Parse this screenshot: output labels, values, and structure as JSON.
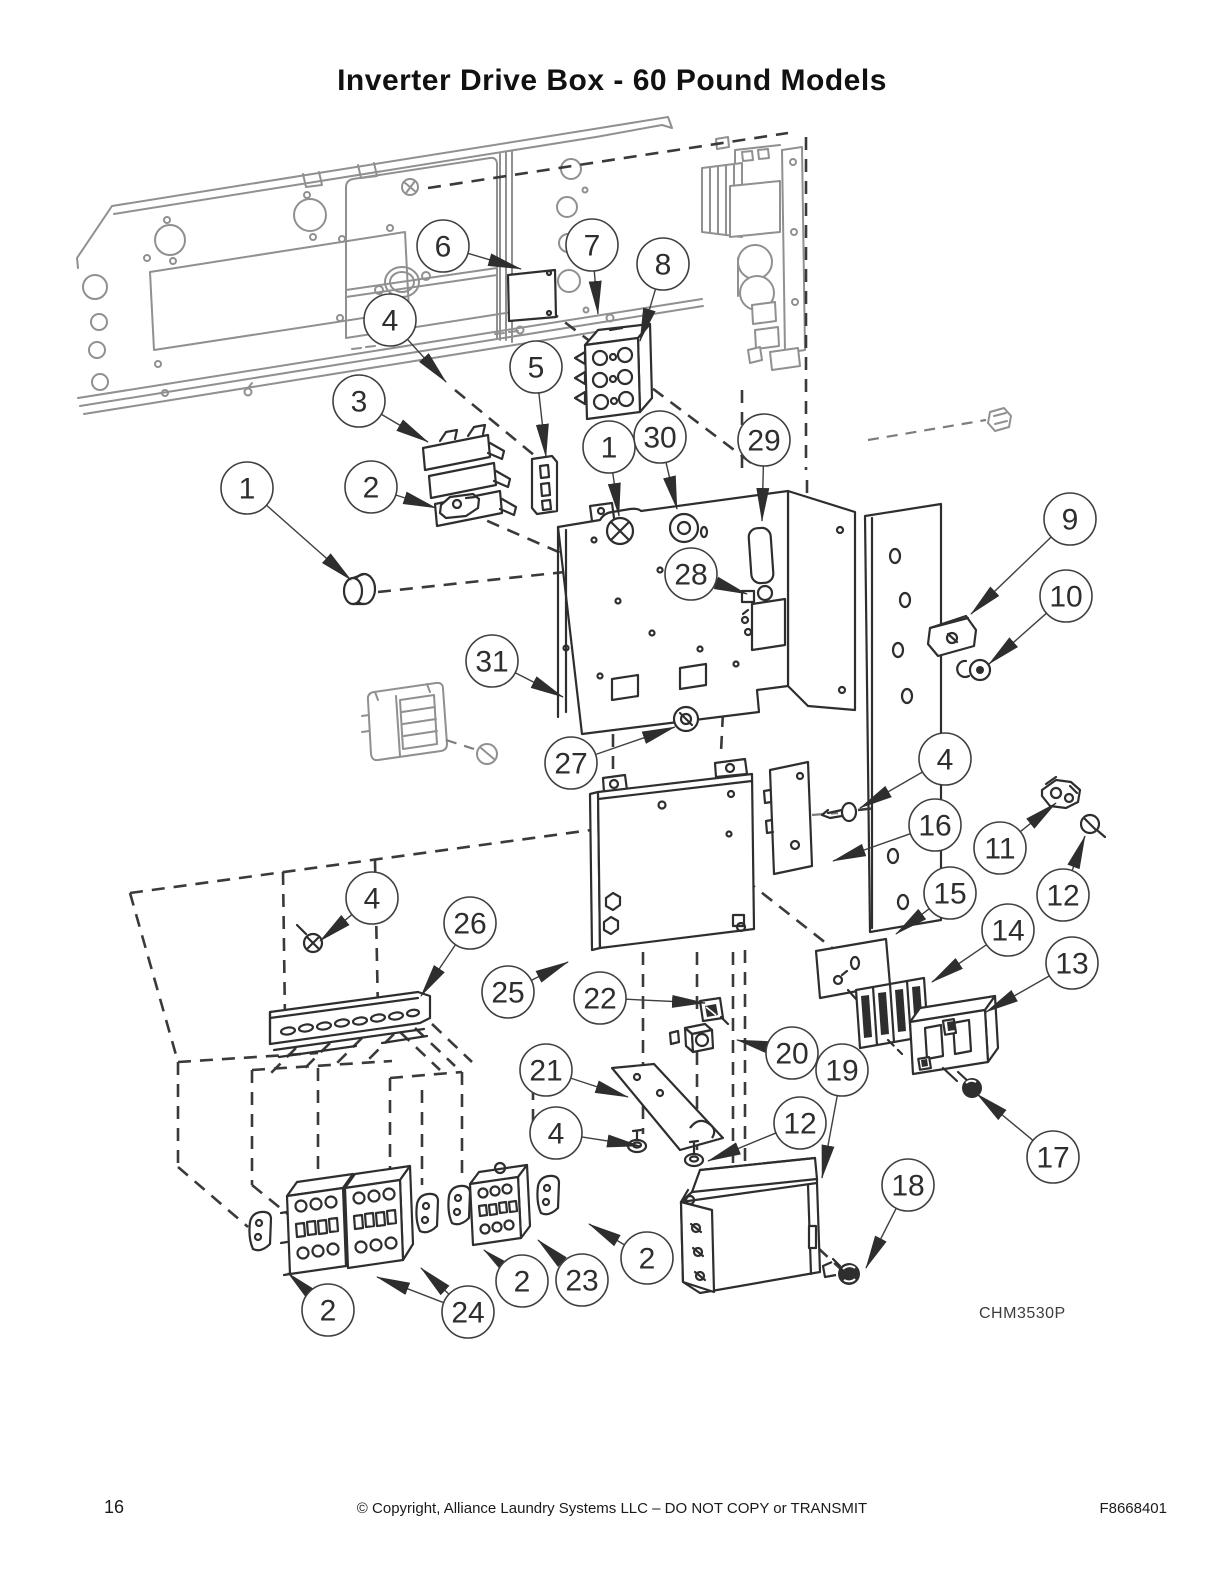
{
  "title": "Inverter Drive Box - 60 Pound Models",
  "figure_code": "CHM3530P",
  "footer": {
    "page_number": "16",
    "copyright": "© Copyright, Alliance Laundry Systems LLC – DO NOT COPY or TRANSMIT",
    "document_number": "F8668401"
  },
  "colors": {
    "ink": "#2e2e2e",
    "ghost": "#909090",
    "balloon_stroke": "#3f3f3f"
  },
  "balloon": {
    "radius": 26,
    "font_size": 30
  },
  "callouts": [
    {
      "label": "6",
      "cx": 443,
      "cy": 246,
      "targets": [
        [
          521,
          269
        ]
      ]
    },
    {
      "label": "7",
      "cx": 592,
      "cy": 245,
      "targets": [
        [
          598,
          314
        ]
      ]
    },
    {
      "label": "8",
      "cx": 663,
      "cy": 264,
      "targets": [
        [
          640,
          341
        ]
      ]
    },
    {
      "label": "4",
      "cx": 390,
      "cy": 320,
      "targets": [
        [
          446,
          382
        ]
      ]
    },
    {
      "label": "5",
      "cx": 536,
      "cy": 367,
      "targets": [
        [
          546,
          457
        ]
      ]
    },
    {
      "label": "3",
      "cx": 359,
      "cy": 401,
      "targets": [
        [
          428,
          442
        ]
      ]
    },
    {
      "label": "1",
      "cx": 609,
      "cy": 447,
      "targets": [
        [
          619,
          516
        ]
      ]
    },
    {
      "label": "30",
      "cx": 660,
      "cy": 437,
      "targets": [
        [
          677,
          509
        ]
      ]
    },
    {
      "label": "29",
      "cx": 764,
      "cy": 440,
      "targets": [
        [
          762,
          521
        ]
      ]
    },
    {
      "label": "1",
      "cx": 247,
      "cy": 488,
      "targets": [
        [
          351,
          580
        ]
      ]
    },
    {
      "label": "2",
      "cx": 371,
      "cy": 487,
      "targets": [
        [
          436,
          508
        ]
      ]
    },
    {
      "label": "9",
      "cx": 1070,
      "cy": 519,
      "targets": [
        [
          971,
          614
        ]
      ]
    },
    {
      "label": "28",
      "cx": 691,
      "cy": 574,
      "targets": [
        [
          747,
          594
        ]
      ]
    },
    {
      "label": "10",
      "cx": 1066,
      "cy": 596,
      "targets": [
        [
          989,
          664
        ]
      ]
    },
    {
      "label": "31",
      "cx": 492,
      "cy": 661,
      "targets": [
        [
          563,
          697
        ]
      ]
    },
    {
      "label": "27",
      "cx": 571,
      "cy": 763,
      "targets": [
        [
          675,
          727
        ]
      ]
    },
    {
      "label": "4",
      "cx": 945,
      "cy": 759,
      "targets": [
        [
          860,
          808
        ]
      ]
    },
    {
      "label": "16",
      "cx": 935,
      "cy": 825,
      "targets": [
        [
          833,
          861
        ]
      ]
    },
    {
      "label": "11",
      "cx": 1000,
      "cy": 848,
      "targets": [
        [
          1056,
          803
        ]
      ]
    },
    {
      "label": "15",
      "cx": 950,
      "cy": 893,
      "targets": [
        [
          896,
          934
        ]
      ]
    },
    {
      "label": "12",
      "cx": 1063,
      "cy": 895,
      "targets": [
        [
          1085,
          836
        ]
      ]
    },
    {
      "label": "14",
      "cx": 1008,
      "cy": 930,
      "targets": [
        [
          932,
          982
        ]
      ]
    },
    {
      "label": "13",
      "cx": 1072,
      "cy": 963,
      "targets": [
        [
          986,
          1012
        ]
      ]
    },
    {
      "label": "4",
      "cx": 372,
      "cy": 898,
      "targets": [
        [
          320,
          941
        ]
      ]
    },
    {
      "label": "26",
      "cx": 470,
      "cy": 923,
      "targets": [
        [
          421,
          996
        ]
      ]
    },
    {
      "label": "25",
      "cx": 508,
      "cy": 992,
      "targets": [
        [
          568,
          962
        ]
      ]
    },
    {
      "label": "22",
      "cx": 600,
      "cy": 998,
      "targets": [
        [
          705,
          1003
        ]
      ]
    },
    {
      "label": "20",
      "cx": 792,
      "cy": 1053,
      "targets": [
        [
          737,
          1040
        ]
      ]
    },
    {
      "label": "21",
      "cx": 546,
      "cy": 1070,
      "targets": [
        [
          628,
          1097
        ]
      ]
    },
    {
      "label": "19",
      "cx": 842,
      "cy": 1070,
      "targets": [
        [
          822,
          1178
        ]
      ]
    },
    {
      "label": "12",
      "cx": 800,
      "cy": 1123,
      "targets": [
        [
          708,
          1161
        ]
      ]
    },
    {
      "label": "4",
      "cx": 556,
      "cy": 1133,
      "targets": [
        [
          640,
          1146
        ]
      ]
    },
    {
      "label": "17",
      "cx": 1053,
      "cy": 1157,
      "targets": [
        [
          977,
          1094
        ]
      ]
    },
    {
      "label": "18",
      "cx": 908,
      "cy": 1185,
      "targets": [
        [
          866,
          1268
        ]
      ]
    },
    {
      "label": "2",
      "cx": 647,
      "cy": 1258,
      "targets": [
        [
          589,
          1224
        ]
      ]
    },
    {
      "label": "23",
      "cx": 582,
      "cy": 1280,
      "targets": [
        [
          538,
          1240
        ]
      ]
    },
    {
      "label": "2",
      "cx": 522,
      "cy": 1281,
      "targets": [
        [
          484,
          1250
        ]
      ]
    },
    {
      "label": "24",
      "cx": 468,
      "cy": 1312,
      "targets": [
        [
          377,
          1277
        ],
        [
          421,
          1268
        ]
      ]
    },
    {
      "label": "2",
      "cx": 328,
      "cy": 1310,
      "targets": [
        [
          288,
          1273
        ]
      ]
    }
  ]
}
